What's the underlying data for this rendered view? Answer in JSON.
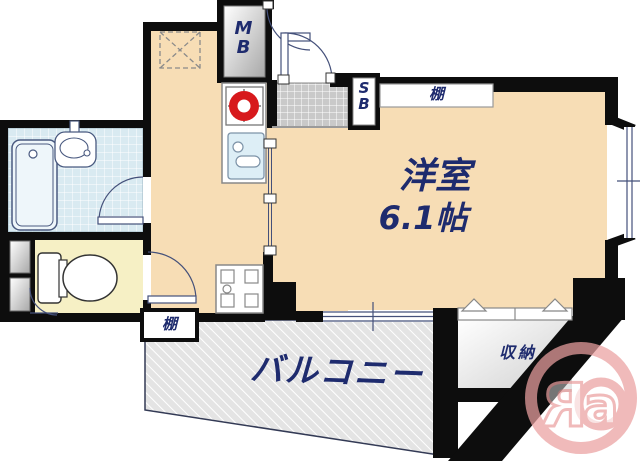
{
  "colors": {
    "floor": "#f7ddb5",
    "wall": "#0d0d0d",
    "text": "#1e2b6e",
    "bath": "#d9eaf1",
    "toilet_floor": "#f6f0c5",
    "balcony_floor": "#e4e4e4",
    "genkan": "#c9c9c9",
    "stove_red": "#d7191c",
    "sink_blue": "#ddeef6",
    "logo_pink": "#eba0a0",
    "line_navy": "#44507a"
  },
  "labels": {
    "meter_box": {
      "top": "M",
      "bottom": "B"
    },
    "shoe_box": {
      "top": "S",
      "bottom": "B"
    },
    "shelf_top": "棚",
    "shelf_bottom": "棚",
    "room_name": "洋室",
    "room_size": "6.1帖",
    "balcony": "バルコニー",
    "storage": "収納"
  },
  "watermark": {
    "letter_r": "R",
    "letter_a": "a"
  }
}
